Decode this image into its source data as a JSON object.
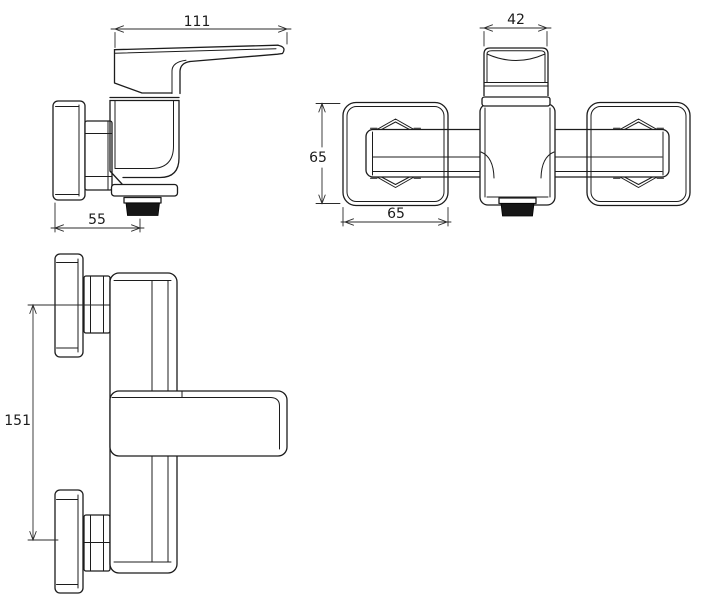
{
  "drawing": {
    "kind": "technical-dimension-drawing",
    "units_implied": "mm",
    "colors": {
      "line": "#1c1c1c",
      "dimension_line": "#2b2b2b",
      "outlet_fill": "#161616",
      "background": "#ffffff"
    },
    "dimensions": {
      "side_view": {
        "overall_width": "111",
        "wall_to_outlet": "55"
      },
      "top_view": {
        "handle_width": "42",
        "flange_height": "65",
        "flange_width": "65"
      },
      "front_view": {
        "connection_distance": "151"
      }
    }
  }
}
